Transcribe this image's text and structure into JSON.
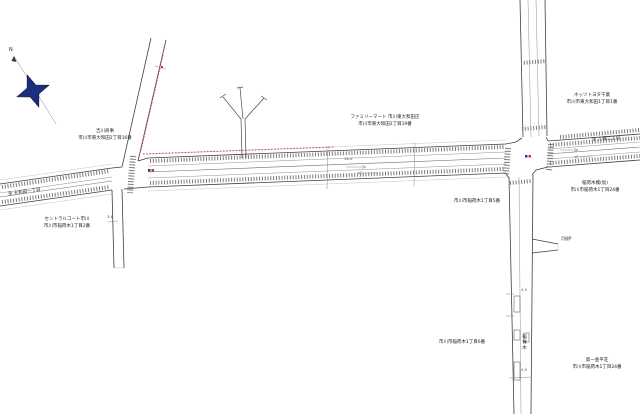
{
  "map": {
    "compass": {
      "north_label": "N"
    },
    "road_destinations": {
      "west": "至 大和田一丁目",
      "east": "至 八幡二丁目"
    },
    "annotations": {
      "building_left": {
        "name": "吉川商事",
        "address": "市川市東大和田2丁目16番"
      },
      "familymart": {
        "name": "ファミリーマート 市川東大和田店",
        "address": "市川市東大和田2丁目19番"
      },
      "netz_toyota": {
        "name": "ネッツトヨタ千葉",
        "address": "市川市東大和田1丁目1番"
      },
      "inarigi_bridge": {
        "name": "稲荷木橋(仮)",
        "address": "市川市稲荷木1丁目24番"
      },
      "block5": {
        "address": "市川市稲荷木1丁目5番"
      },
      "court": {
        "name": "セントラルコート市川",
        "address": "市川市稲荷木1丁目2番"
      },
      "block6": {
        "address": "市川市稲荷木1丁目6番"
      },
      "daiichi": {
        "name": "第一金平荘",
        "address": "市川市稲荷木1丁目24番"
      },
      "parking": "月極P",
      "vertical_road_name": "稲荷木"
    },
    "measurements": {
      "street_width_left": "3.6",
      "width_upper": "4.5",
      "width_lower": "4.5",
      "road_width_main": "16.0"
    },
    "colors": {
      "road_line": "#3f3f3f",
      "survey_red": "#cc4545",
      "compass_fill": "#1b2f7e",
      "signal_blue": "#2438a0",
      "signal_red": "#c23333"
    }
  }
}
